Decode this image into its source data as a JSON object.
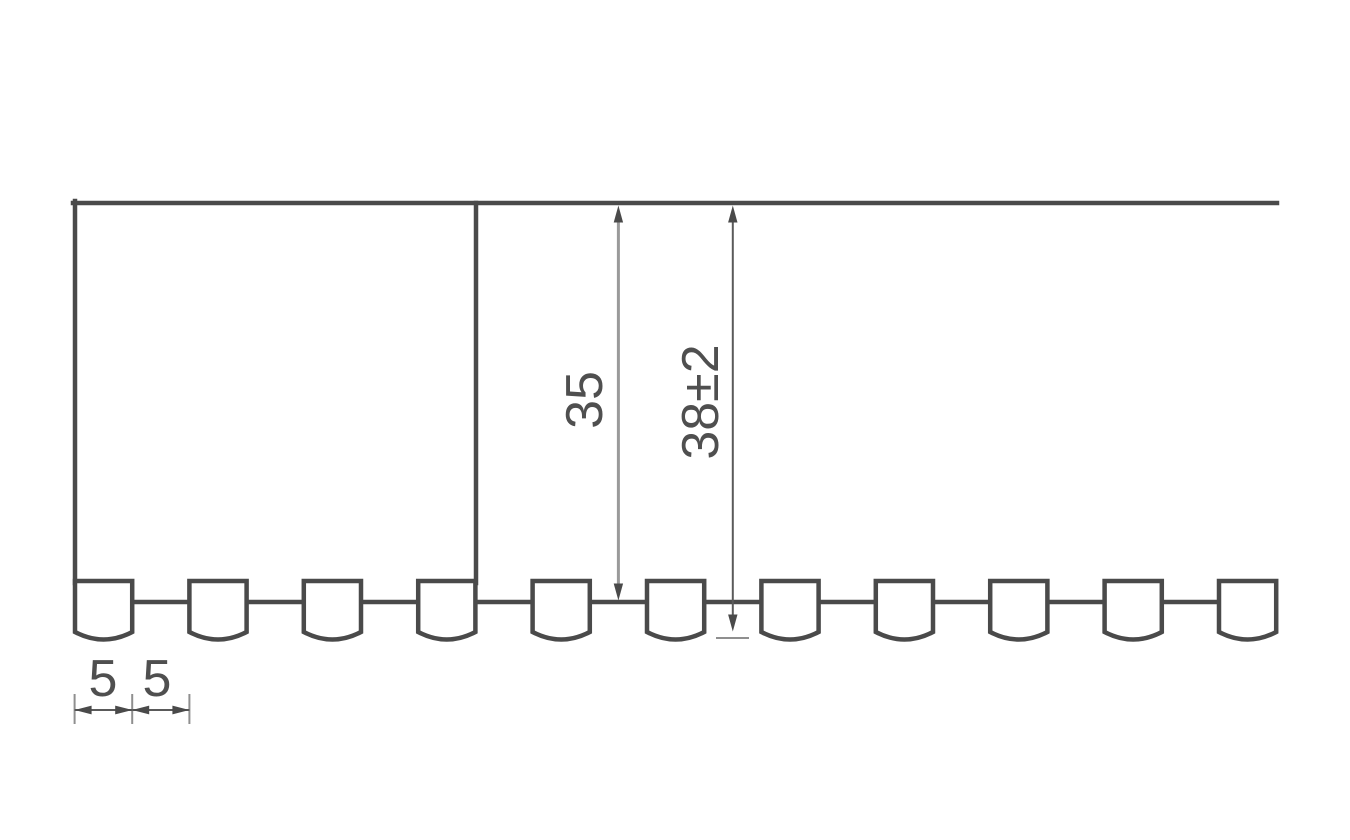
{
  "diagram": {
    "type": "technical-drawing",
    "description": "Cross-section profile with toothed lower edge and dimension callouts",
    "vertical_dimensions": [
      {
        "label": "35"
      },
      {
        "label": "38±2"
      }
    ],
    "horizontal_dimensions": [
      {
        "label": "5"
      },
      {
        "label": "5"
      }
    ],
    "teeth_count": 11,
    "colors": {
      "structure": "#4a4a4a",
      "dimension": "#5a5a5a",
      "dimension_light": "#9a9a9a",
      "extension": "#8f8f8f",
      "text": "#4f4f4f",
      "background": "#ffffff"
    }
  }
}
